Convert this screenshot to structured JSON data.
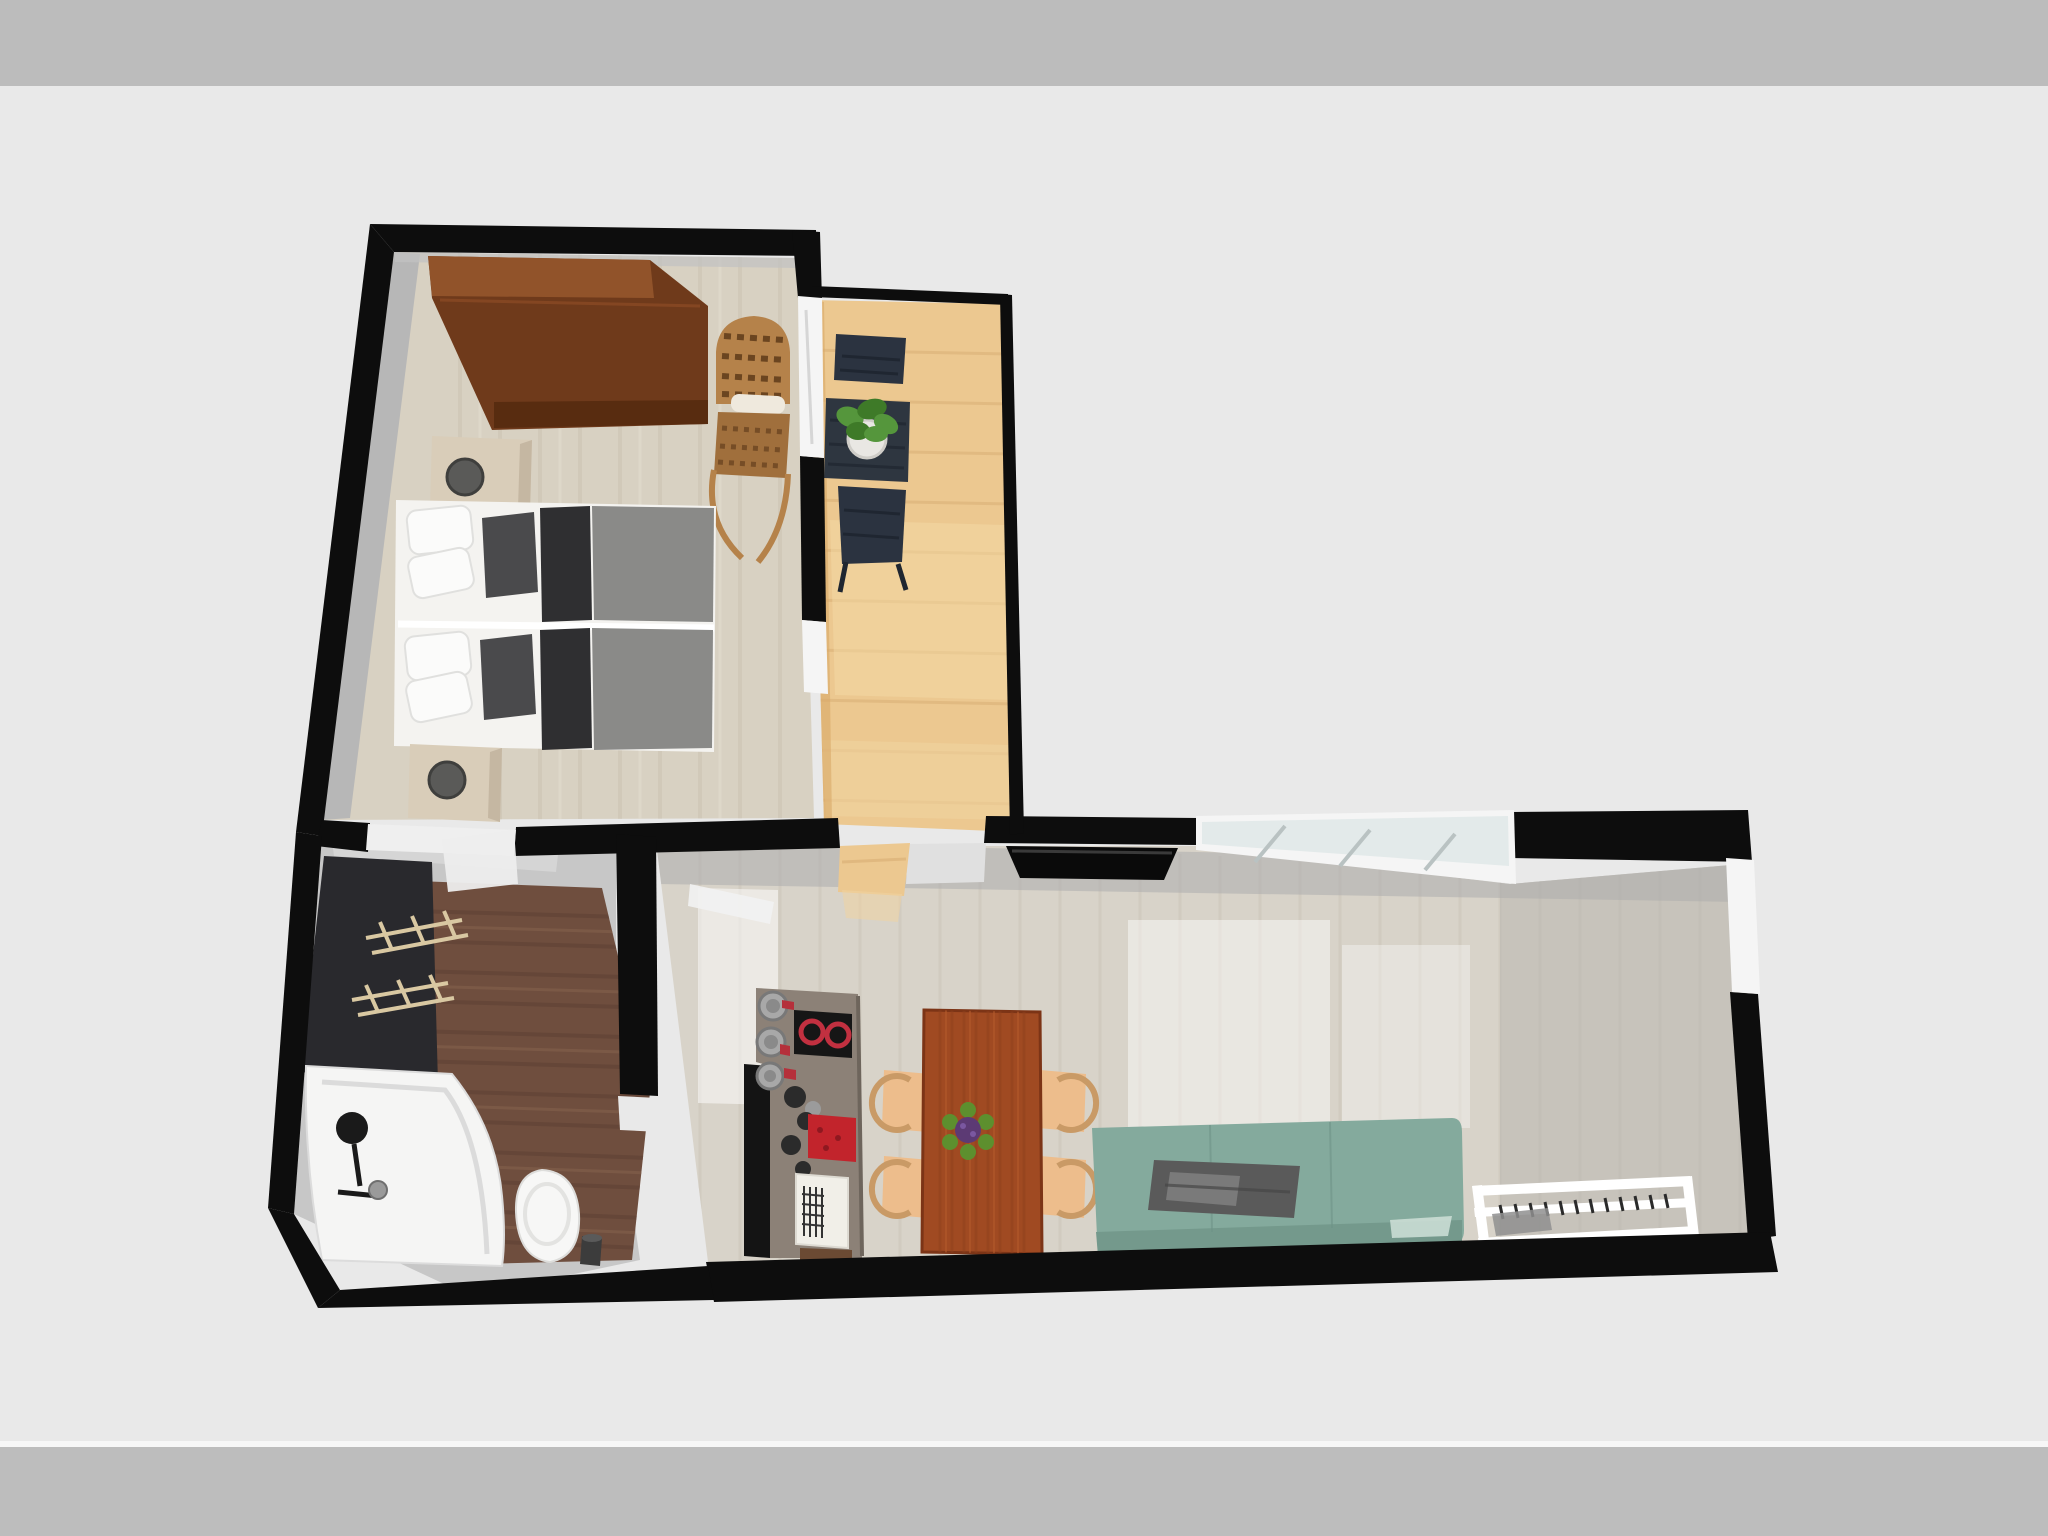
{
  "app": {
    "name": "3d-floor-plan-render",
    "view": "top-down-perspective"
  },
  "palette": {
    "band_top": "#bcbcbc",
    "canvas": "#e9e9e9",
    "band_bottom": "#bdbdbd",
    "hairline": "#f7f7f7",
    "wall": "#0d0d0d",
    "bedroom_floor": "#d8d1c2",
    "bedroom_shadow": "#b7b7b7",
    "balcony_floor": "#ecc890",
    "hall_floor": "#c7c7c7",
    "entry_wood": "#6f4e3e",
    "living_floor": "#d8d3c9",
    "charcoal_mat": "#29292d",
    "rack_tan": "#d9c8a2",
    "window_frame": "#f5f5f5",
    "window_glass": "#e3eaea",
    "threshold": "#efefef",
    "wardrobe": "#6f3a1b",
    "wardrobe_top": "#91532a",
    "wardrobe_lip": "#582c10",
    "rattan": "#b5824a",
    "rattan_seat": "#a06f3c",
    "rattan_slot": "#efe9dd",
    "bed_white": "#f4f3f0",
    "duvet": "#8a8a88",
    "throw_dark": "#2f2f31",
    "pillow_dark": "#4a4a4c",
    "nightstand": "#d9cdb9",
    "lamp": "#5a5a58",
    "bistro_table": "#2e3640",
    "bistro_chair": "#2b3340",
    "plant_green": "#55963c",
    "plant_green_dark": "#3e7a28",
    "plant_pot": "#e9e7e3",
    "tv": "#0a0a0a",
    "counter": "#8c8177",
    "counter_panel": "#141414",
    "pot_gray": "#a8a8a8",
    "cooktop": "#161616",
    "burner_red": "#c23040",
    "accent_red": "#b5303b",
    "sink_red": "#c2242c",
    "drainer": "#f1efe8",
    "cabinet_wood": "#6b4a33",
    "knob_dark": "#2b2b2b",
    "dining_table": "#a04a22",
    "flower_purple": "#5c3a74",
    "flower_leaf": "#5d8f2e",
    "chair_tan": "#edbd8c",
    "chair_ring": "#c99a66",
    "sofa": "#84aa9d",
    "sofa_back": "#74998c",
    "sofa_blanket": "#5a5a5a",
    "sofa_blanket_light": "#7a7a7a",
    "sofa_highlight": "#cfe0d8",
    "rack_white": "#ffffff",
    "rack_hook": "#2b2b2b",
    "rack_item": "#8f8f8f",
    "tub": "#f5f5f4",
    "tub_line": "#d8d8d8",
    "drain": "#1a1a1a",
    "shower_gray": "#9a9a9a",
    "toilet": "#f7f7f6",
    "bin": "#3c3c3c",
    "door_white": "#ededed"
  },
  "rooms": [
    {
      "id": "bedroom",
      "items": [
        "wardrobe",
        "wicker-chair",
        "nightstand",
        "table-lamp",
        "twin-bed",
        "twin-bed",
        "nightstand",
        "table-lamp"
      ]
    },
    {
      "id": "balcony",
      "items": [
        "bistro-chair",
        "bistro-table",
        "potted-plant",
        "bistro-chair"
      ]
    },
    {
      "id": "entry-hall",
      "items": [
        "dark-mat",
        "coat-rack",
        "coat-rack"
      ]
    },
    {
      "id": "bathroom",
      "items": [
        "bathtub",
        "shower-handset",
        "toilet",
        "waste-bin"
      ]
    },
    {
      "id": "living-room",
      "items": [
        "kitchenette-counter",
        "cooktop",
        "red-sink",
        "dish-drainer",
        "wall-tv",
        "dining-table",
        "dining-chair",
        "dining-chair",
        "dining-chair",
        "dining-chair",
        "sofa",
        "throw-blanket",
        "wall-rack"
      ]
    }
  ]
}
